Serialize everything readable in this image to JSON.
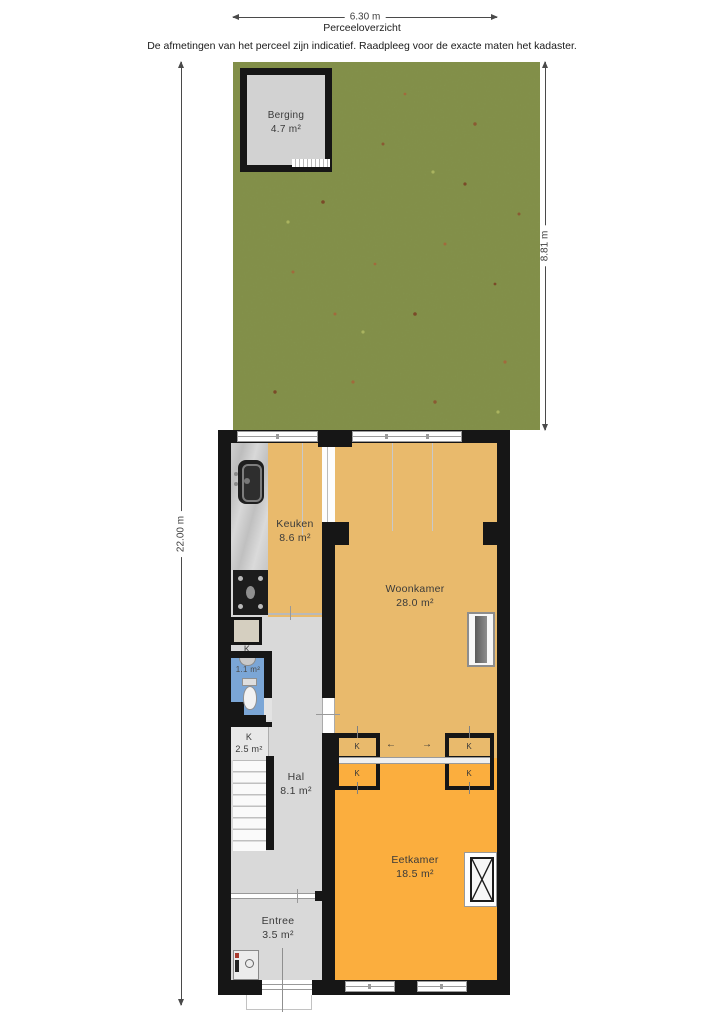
{
  "header": {
    "plot_width": "6.30 m",
    "title": "Perceeloverzicht",
    "disclaimer": "De afmetingen van het perceel zijn indicatief. Raadpleeg voor de exacte maten het kadaster."
  },
  "dimensions": {
    "total_depth": "22.00 m",
    "garden_depth": "8.81 m"
  },
  "garden": {
    "shed_name": "Berging",
    "shed_area": "4.7 m²"
  },
  "rooms": {
    "keuken": {
      "name": "Keuken",
      "area": "8.6 m²"
    },
    "woonkamer": {
      "name": "Woonkamer",
      "area": "28.0 m²"
    },
    "toilet": {
      "area": "1.1 m²"
    },
    "kast": {
      "label": "K",
      "area": "2.5 m²"
    },
    "hal": {
      "name": "Hal",
      "area": "8.1 m²"
    },
    "eetkamer": {
      "name": "Eetkamer",
      "area": "18.5 m²"
    },
    "entree": {
      "name": "Entree",
      "area": "3.5 m²"
    },
    "closet_label": "K"
  },
  "sliding_door": {
    "left_arrow": "←",
    "right_arrow": "→"
  },
  "colors": {
    "wall": "#161616",
    "living_floor": "#e9ba6c",
    "dining_floor": "#fbae3e",
    "hall_floor": "#d9d9d9",
    "toilet_floor": "#7ba6d6",
    "garden_green": "#87944e"
  }
}
